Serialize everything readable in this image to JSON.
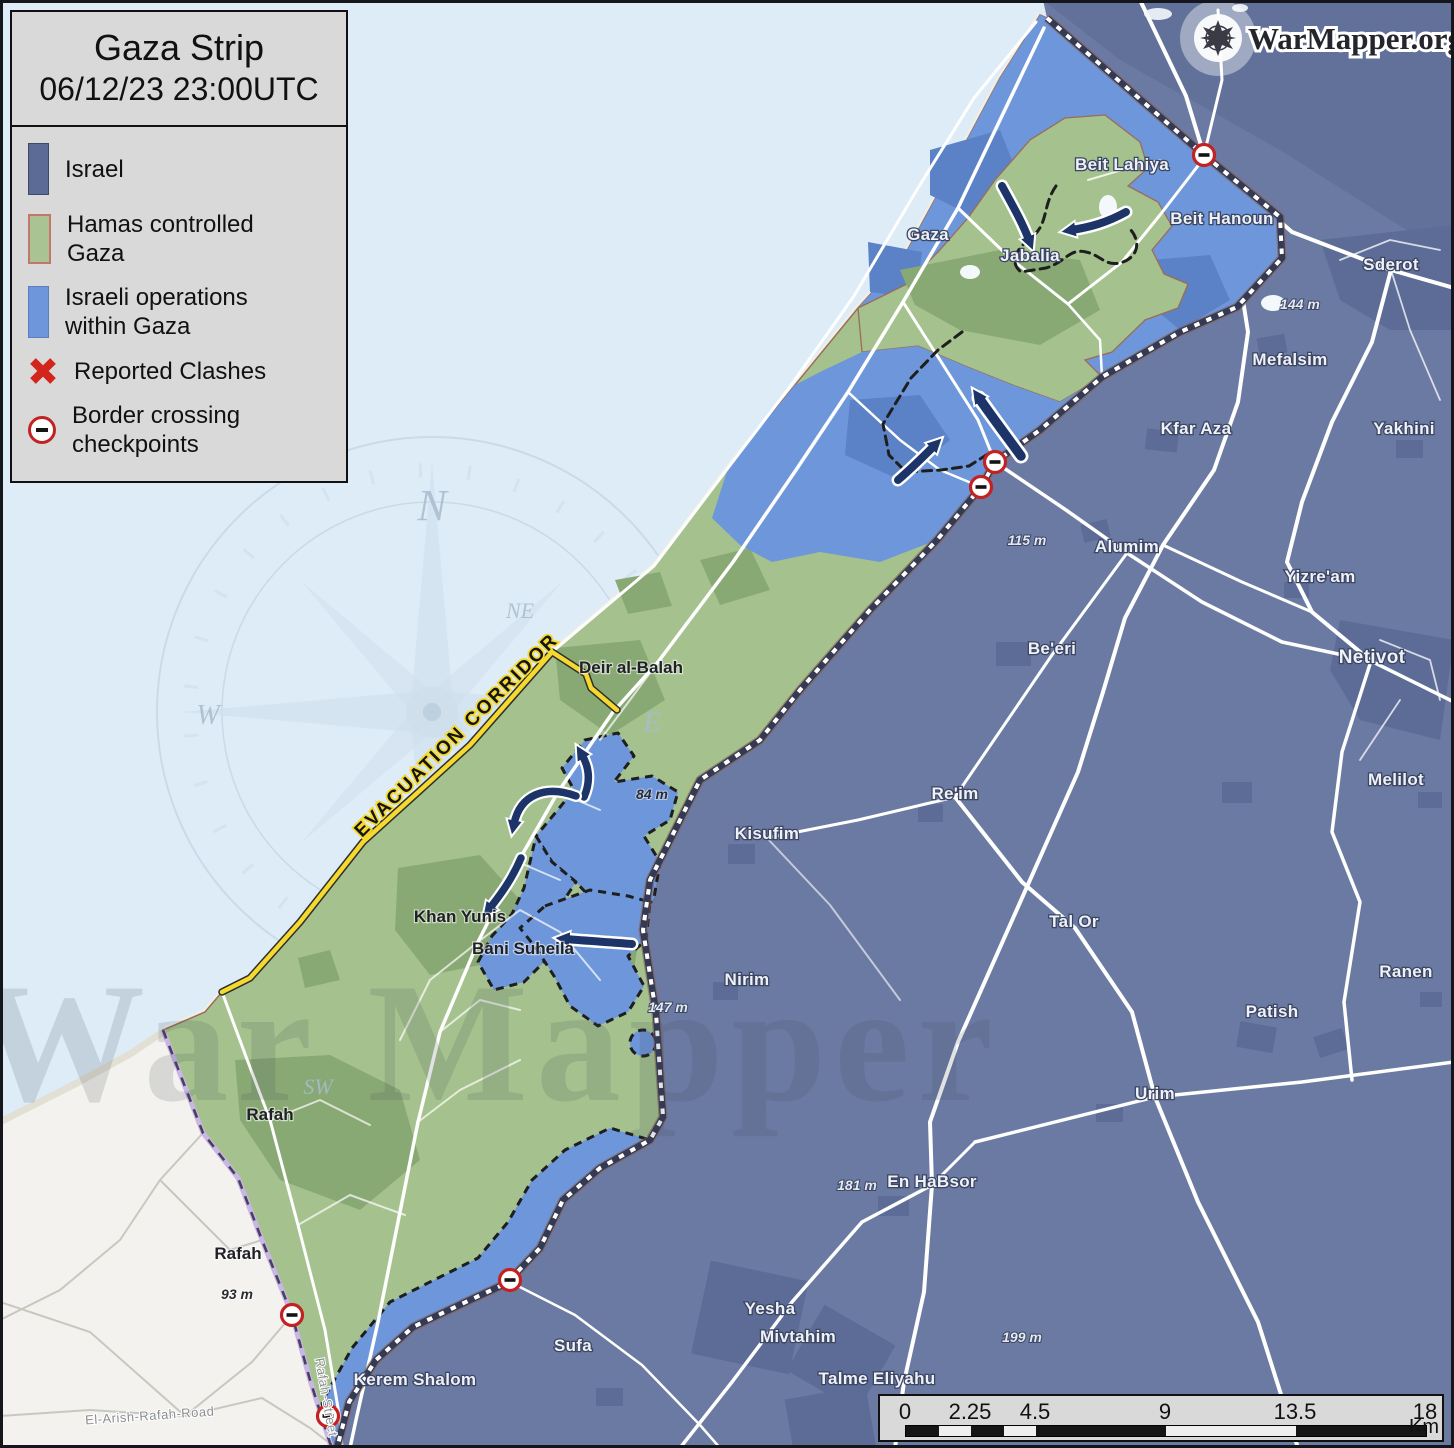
{
  "app": {
    "brand": "WarMapper.org"
  },
  "header": {
    "title": "Gaza Strip",
    "timestamp": "06/12/23 23:00UTC"
  },
  "legend": {
    "items": [
      {
        "label": "Israel"
      },
      {
        "label": "Hamas controlled Gaza"
      },
      {
        "label": "Israeli operations within Gaza"
      },
      {
        "label": "Reported Clashes"
      },
      {
        "label": "Border crossing checkpoints"
      }
    ]
  },
  "map": {
    "corridor_label": "EVACUATION CORRIDOR",
    "watermark": "War Mapper",
    "colors": {
      "sea": "#ddecf7",
      "israel": "#6b7aa2",
      "hamas_gaza": "#a5c28e",
      "israeli_ops": "#6e96da",
      "egypt": "#f3f2ee",
      "arrow_navy": "#1c3468",
      "clash_red": "#d2251c",
      "checkpoint_red": "#c32222",
      "corridor_yellow": "#f5d92e"
    },
    "checkpoints": [
      {
        "x": 1204,
        "y": 155
      },
      {
        "x": 995,
        "y": 462
      },
      {
        "x": 981,
        "y": 487
      },
      {
        "x": 510,
        "y": 1280
      },
      {
        "x": 292,
        "y": 1315
      },
      {
        "x": 328,
        "y": 1416
      }
    ],
    "labels": [
      {
        "id": "beit-lahiya",
        "text": "Beit Lahiya",
        "x": 1122,
        "y": 170,
        "cls": "w"
      },
      {
        "id": "beit-hanoun",
        "text": "Beit Hanoun",
        "x": 1222,
        "y": 224,
        "cls": "w"
      },
      {
        "id": "gaza-city",
        "text": "Gaza",
        "x": 928,
        "y": 240,
        "cls": "w"
      },
      {
        "id": "jabalia",
        "text": "Jabalia",
        "x": 1030,
        "y": 261,
        "cls": "w"
      },
      {
        "id": "sderot",
        "text": "Sderot",
        "x": 1391,
        "y": 270,
        "cls": "w"
      },
      {
        "id": "mefalsim",
        "text": "Mefalsim",
        "x": 1290,
        "y": 365,
        "cls": "w"
      },
      {
        "id": "kfar-aza",
        "text": "Kfar Aza",
        "x": 1196,
        "y": 434,
        "cls": "w"
      },
      {
        "id": "yakhini",
        "text": "Yakhini",
        "x": 1404,
        "y": 434,
        "cls": "w"
      },
      {
        "id": "alumim",
        "text": "Alumim",
        "x": 1127,
        "y": 552,
        "cls": "w"
      },
      {
        "id": "yizream",
        "text": "Yizre'am",
        "x": 1320,
        "y": 582,
        "cls": "w"
      },
      {
        "id": "beeri",
        "text": "Be'eri",
        "x": 1052,
        "y": 654,
        "cls": "w"
      },
      {
        "id": "netivot",
        "text": "Netivot",
        "x": 1372,
        "y": 663,
        "cls": "w",
        "fs": 19
      },
      {
        "id": "melilot",
        "text": "Melilot",
        "x": 1396,
        "y": 785,
        "cls": "w"
      },
      {
        "id": "reim",
        "text": "Re'im",
        "x": 955,
        "y": 799,
        "cls": "w"
      },
      {
        "id": "kisufim",
        "text": "Kisufim",
        "x": 767,
        "y": 839,
        "cls": "w"
      },
      {
        "id": "tal-or",
        "text": "Tal Or",
        "x": 1074,
        "y": 927,
        "cls": "w"
      },
      {
        "id": "nirim",
        "text": "Nirim",
        "x": 747,
        "y": 985,
        "cls": "w"
      },
      {
        "id": "ranen",
        "text": "Ranen",
        "x": 1406,
        "y": 977,
        "cls": "w"
      },
      {
        "id": "patish",
        "text": "Patish",
        "x": 1272,
        "y": 1017,
        "cls": "w"
      },
      {
        "id": "urim",
        "text": "Urim",
        "x": 1155,
        "y": 1099,
        "cls": "w"
      },
      {
        "id": "en-habsor",
        "text": "En HaBsor",
        "x": 932,
        "y": 1187,
        "cls": "w"
      },
      {
        "id": "yesha",
        "text": "Yesha",
        "x": 770,
        "y": 1314,
        "cls": "w"
      },
      {
        "id": "mivtahim",
        "text": "Mivtahim",
        "x": 798,
        "y": 1342,
        "cls": "w"
      },
      {
        "id": "talme-eliyahu",
        "text": "Talme Eliyahu",
        "x": 877,
        "y": 1384,
        "cls": "w"
      },
      {
        "id": "sufa",
        "text": "Sufa",
        "x": 573,
        "y": 1351,
        "cls": "w"
      },
      {
        "id": "kerem-shalom",
        "text": "Kerem Shalom",
        "x": 415,
        "y": 1385,
        "cls": "w"
      },
      {
        "id": "deir-al-balah",
        "text": "Deir al-Balah",
        "x": 631,
        "y": 673,
        "cls": "d"
      },
      {
        "id": "khan-yunis",
        "text": "Khan Yunis",
        "x": 460,
        "y": 922,
        "cls": "d"
      },
      {
        "id": "bani-suheila",
        "text": "Bani Suheila",
        "x": 523,
        "y": 954,
        "cls": "d"
      },
      {
        "id": "rafah-gaza",
        "text": "Rafah",
        "x": 270,
        "y": 1120,
        "cls": "d"
      },
      {
        "id": "rafah-egypt",
        "text": "Rafah",
        "x": 238,
        "y": 1259,
        "cls": "d"
      },
      {
        "id": "elev-144",
        "text": "144 m",
        "x": 1300,
        "y": 309,
        "cls": "ew"
      },
      {
        "id": "elev-115",
        "text": "115 m",
        "x": 1027,
        "y": 545,
        "cls": "ew"
      },
      {
        "id": "elev-84",
        "text": "84 m",
        "x": 652,
        "y": 799,
        "cls": "ed"
      },
      {
        "id": "elev-147",
        "text": "147 m",
        "x": 668,
        "y": 1012,
        "cls": "ew"
      },
      {
        "id": "elev-181",
        "text": "181 m",
        "x": 857,
        "y": 1190,
        "cls": "ew"
      },
      {
        "id": "elev-199",
        "text": "199 m",
        "x": 1022,
        "y": 1342,
        "cls": "ew"
      },
      {
        "id": "elev-93",
        "text": "93 m",
        "x": 237,
        "y": 1299,
        "cls": "ed"
      },
      {
        "id": "el-arish-rafah-road",
        "text": "El-Arish-Rafah-Road",
        "x": 150,
        "y": 1420,
        "cls": "road",
        "rot": -4
      },
      {
        "id": "rafah-street",
        "text": "Rafah-Street",
        "x": 322,
        "y": 1398,
        "cls": "road",
        "rot": 80
      },
      {
        "id": "compass-n",
        "text": "N",
        "x": 432,
        "y": 520,
        "cls": "compass",
        "fs": 44
      },
      {
        "id": "compass-ne",
        "text": "NE",
        "x": 520,
        "y": 618,
        "cls": "compass",
        "fs": 22
      },
      {
        "id": "compass-w",
        "text": "W",
        "x": 208,
        "y": 724,
        "cls": "compass",
        "fs": 28
      },
      {
        "id": "compass-e",
        "text": "E",
        "x": 652,
        "y": 732,
        "cls": "compass",
        "fs": 30
      },
      {
        "id": "compass-sw",
        "text": "SW",
        "x": 318,
        "y": 1094,
        "cls": "compass",
        "fs": 22
      }
    ]
  },
  "scalebar": {
    "ticks": [
      "0",
      "2.25",
      "4.5",
      "9",
      "13.5",
      "18"
    ],
    "unit": "Km"
  }
}
